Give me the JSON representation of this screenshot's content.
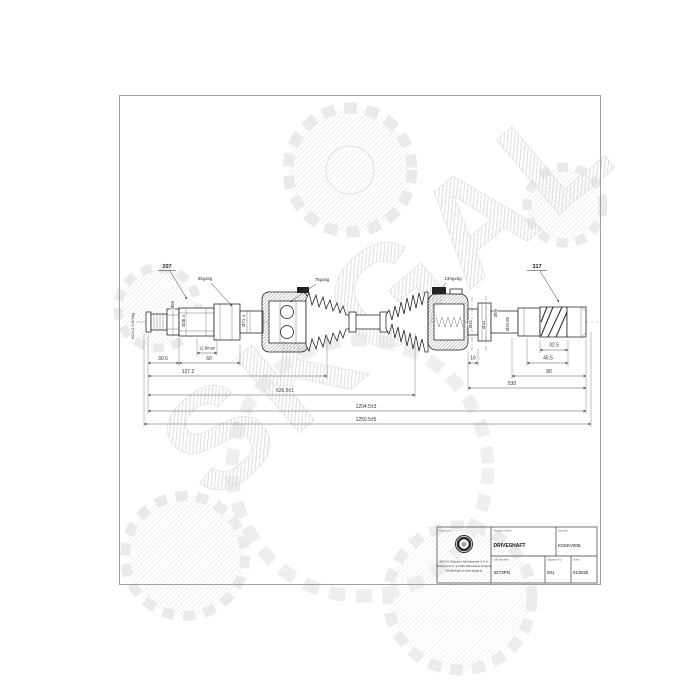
{
  "wm": {
    "text": "SKGAL"
  },
  "labels": {
    "ref_left": "207",
    "ref_right": "317",
    "grease_outer": "90g±5g",
    "grease_boot": "75g±5g",
    "grease_inner": "130g±5g",
    "thread": "M24x1.5-6H/6g"
  },
  "dims": {
    "d30": "30.6",
    "d128": "12.8max",
    "d60": "60",
    "d127": "127.2",
    "d626": "626.5±1",
    "d1204": "1204.5±3",
    "d1250": "1250.5±5",
    "d16": "16",
    "d32": "32.5",
    "d45": "45.5",
    "d80": "80",
    "d530": "530"
  },
  "dias": {
    "hub": "Ø56",
    "stub": "Ø30.4",
    "flange": "Ø71.4",
    "neck": "Ø41",
    "ring": "Ø33",
    "housing": "Ø96",
    "abs": "Ø34.85"
  },
  "tb": {
    "producer_label": "Producer",
    "company1": "SKGAL Wojciech Michałowski S.K.A.",
    "company2": "Fabryczna 5, 21-400 Warszawa, Poland",
    "company3": "info@skgal.pl  www.skgal.pl",
    "product_label": "Product name",
    "product": "DRIVESHAFT",
    "symbol_label": "Symbol",
    "symbol": "K0SKV005",
    "oe_label": "OE Number",
    "oe": "3273PN",
    "diagram_label": "Diagram No.",
    "diagram": "001",
    "date_label": "Date",
    "date": "01/2025"
  }
}
